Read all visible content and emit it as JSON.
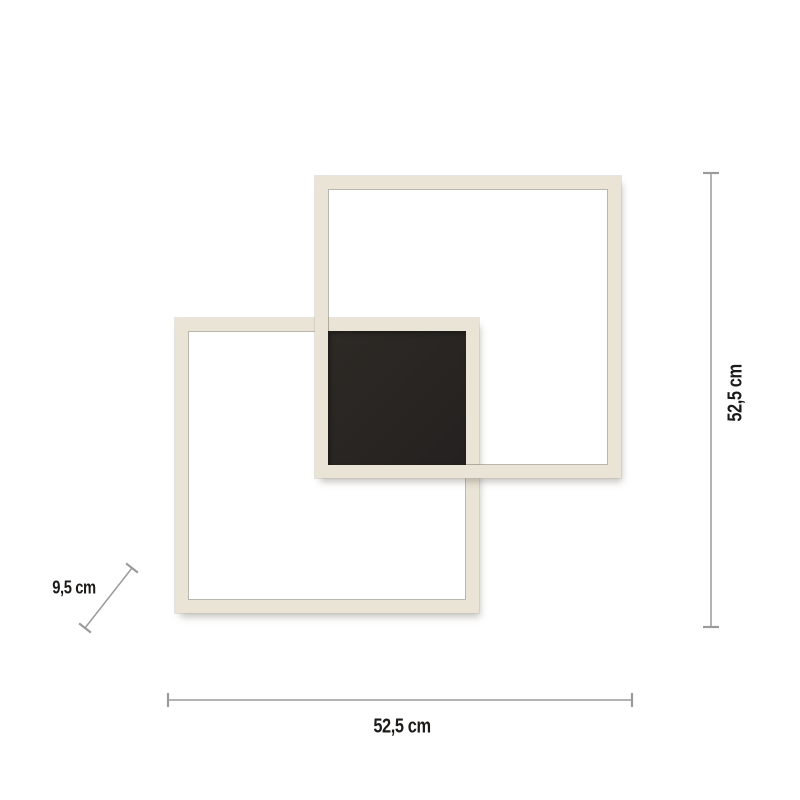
{
  "diagram": {
    "type": "product-dimension-diagram",
    "subject": "ceiling lamp with two interlocking square frames and black center panel",
    "labels": {
      "width": "52,5 cm",
      "height": "52,5 cm",
      "depth": "9,5 cm"
    },
    "colors": {
      "frame": "#e9e4d6",
      "frame_inner_edge": "#807a6a",
      "center_panel": "#282522",
      "dimension_line": "#9b9b9b",
      "label_text": "#1d1b19",
      "background": "#ffffff"
    }
  }
}
